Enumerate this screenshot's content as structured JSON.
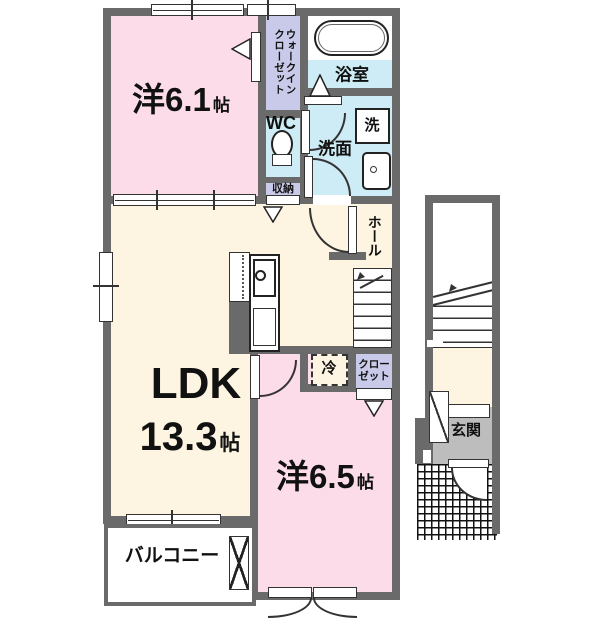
{
  "rooms": {
    "bedroom1": {
      "name": "洋6.1",
      "unit": "帖"
    },
    "bedroom2": {
      "name": "洋6.5",
      "unit": "帖"
    },
    "ldk": {
      "name": "LDK",
      "size": "13.3",
      "unit": "帖"
    },
    "walk_in_closet": {
      "name": "ウォークイン\nクローゼット"
    },
    "bathroom": {
      "name": "浴室"
    },
    "toilet": {
      "name": "WC"
    },
    "washroom": {
      "name": "洗面"
    },
    "washer": {
      "name": "洗"
    },
    "storage": {
      "name": "収納"
    },
    "hall": {
      "name": "ホール"
    },
    "refrigerator": {
      "name": "冷"
    },
    "closet": {
      "name": "クロー\nゼット"
    },
    "balcony": {
      "name": "バルコニー"
    },
    "entrance": {
      "name": "玄関"
    }
  },
  "colors": {
    "wall": "#6a6a6a",
    "bedroom_pink": "#fbdce8",
    "ldk_cream": "#fdf4e1",
    "wet_area_blue": "#cdecf5",
    "closet_purple": "#c9c9e9",
    "entrance_gray": "#bdbdbd"
  }
}
